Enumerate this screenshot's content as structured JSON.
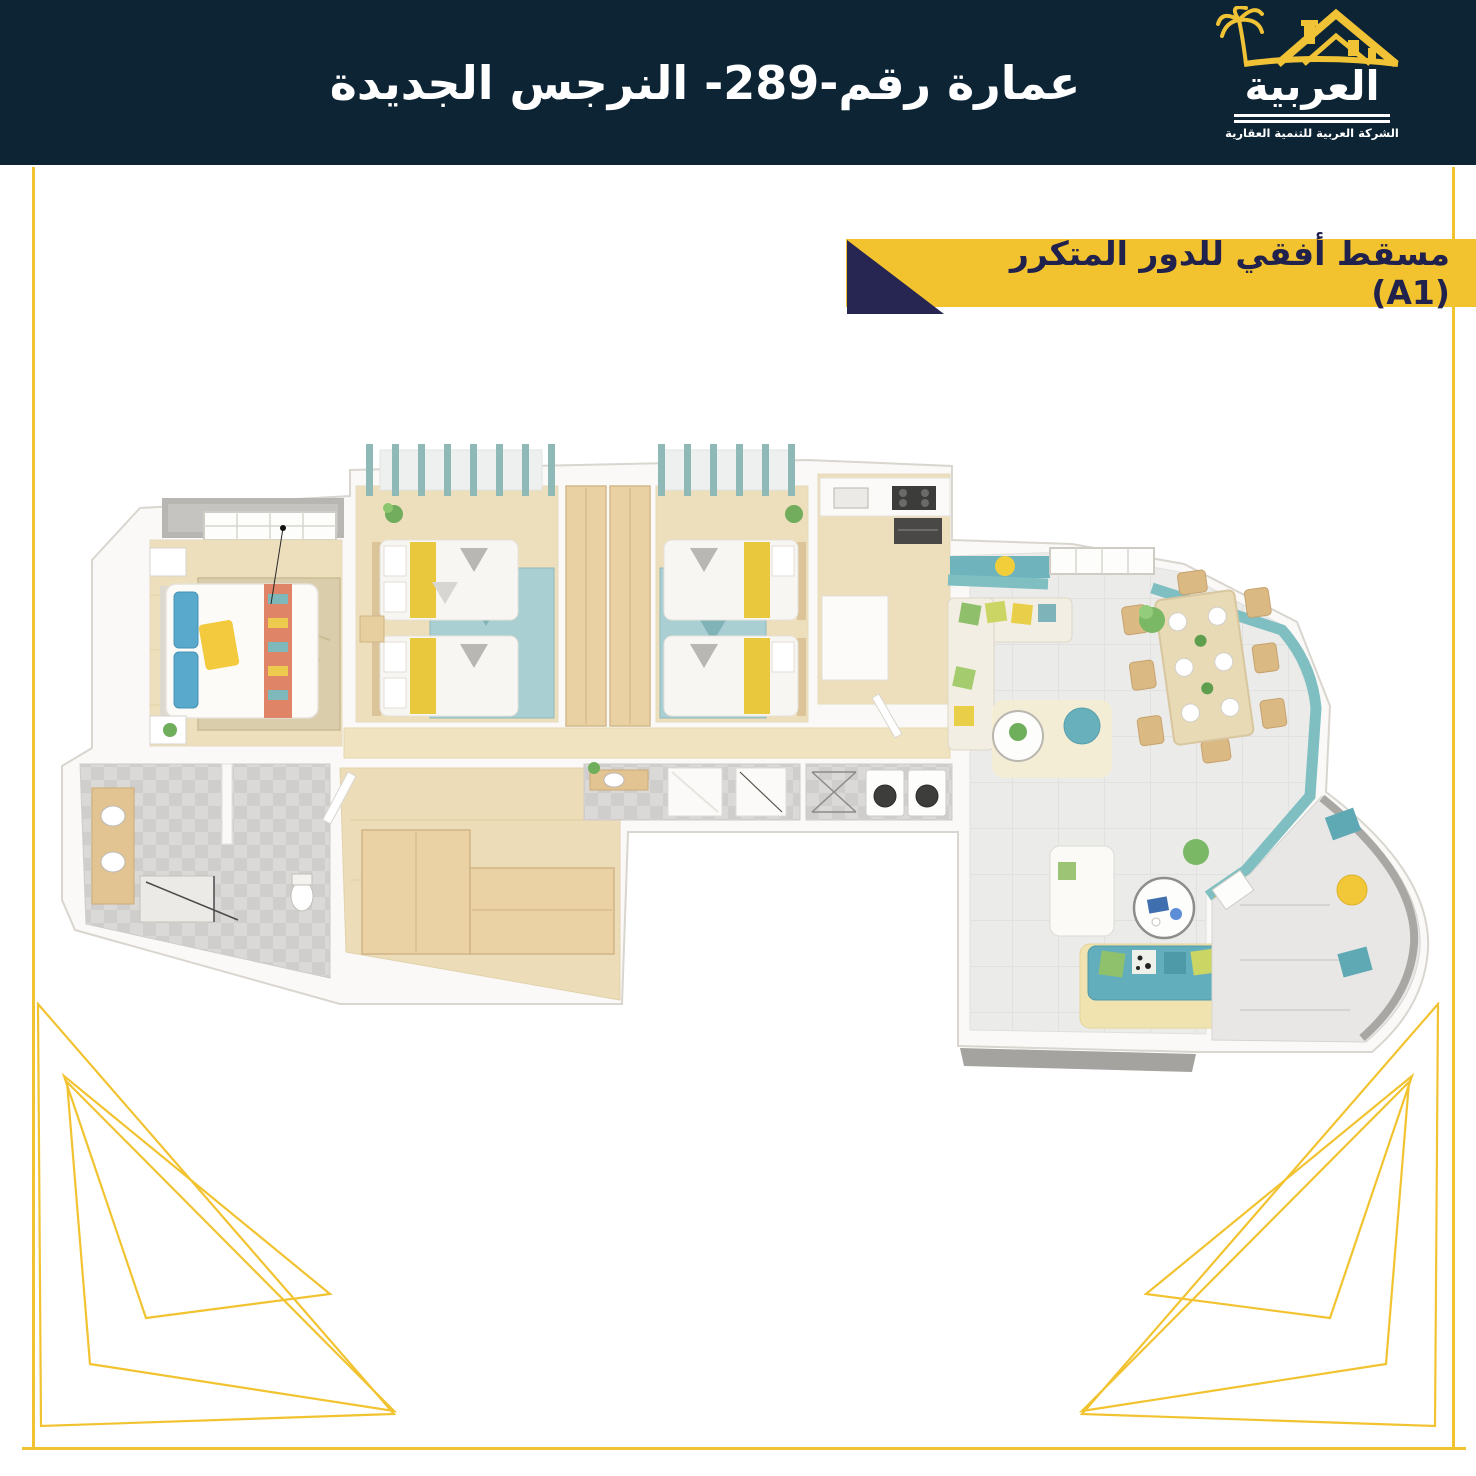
{
  "header": {
    "title": "عمارة رقم-289- النرجس الجديدة",
    "background": "#0d2435",
    "text_color": "#ffffff"
  },
  "logo": {
    "brand": "العربية",
    "subtitle": "الشركة العربية للتنمية العقارية",
    "icon": "palm-and-house-icon",
    "accent": "#f0c235"
  },
  "banner": {
    "label": "مسقط أفقي للدور المتكرر  (A1)",
    "background": "#f3c32f",
    "triangle_color": "#272552",
    "text_color": "#20214c"
  },
  "palette": {
    "header_navy": "#0d2435",
    "accent_yellow": "#f2c330",
    "banner_navy": "#272552",
    "teal_wall": "#7fbfc1",
    "teal_sofa": "#63aebc",
    "wood_floor": "#eedfbc",
    "wood_furniture": "#e9d1a3",
    "tile_gray": "#d9d8d6",
    "rug_beige": "#dacdab",
    "pillow_blue": "#58a9cb",
    "runner_coral": "#e08468",
    "leaf_green": "#6fae5b",
    "living_tile": "#ebebe9",
    "balcony_gray": "#b8b6b3"
  }
}
